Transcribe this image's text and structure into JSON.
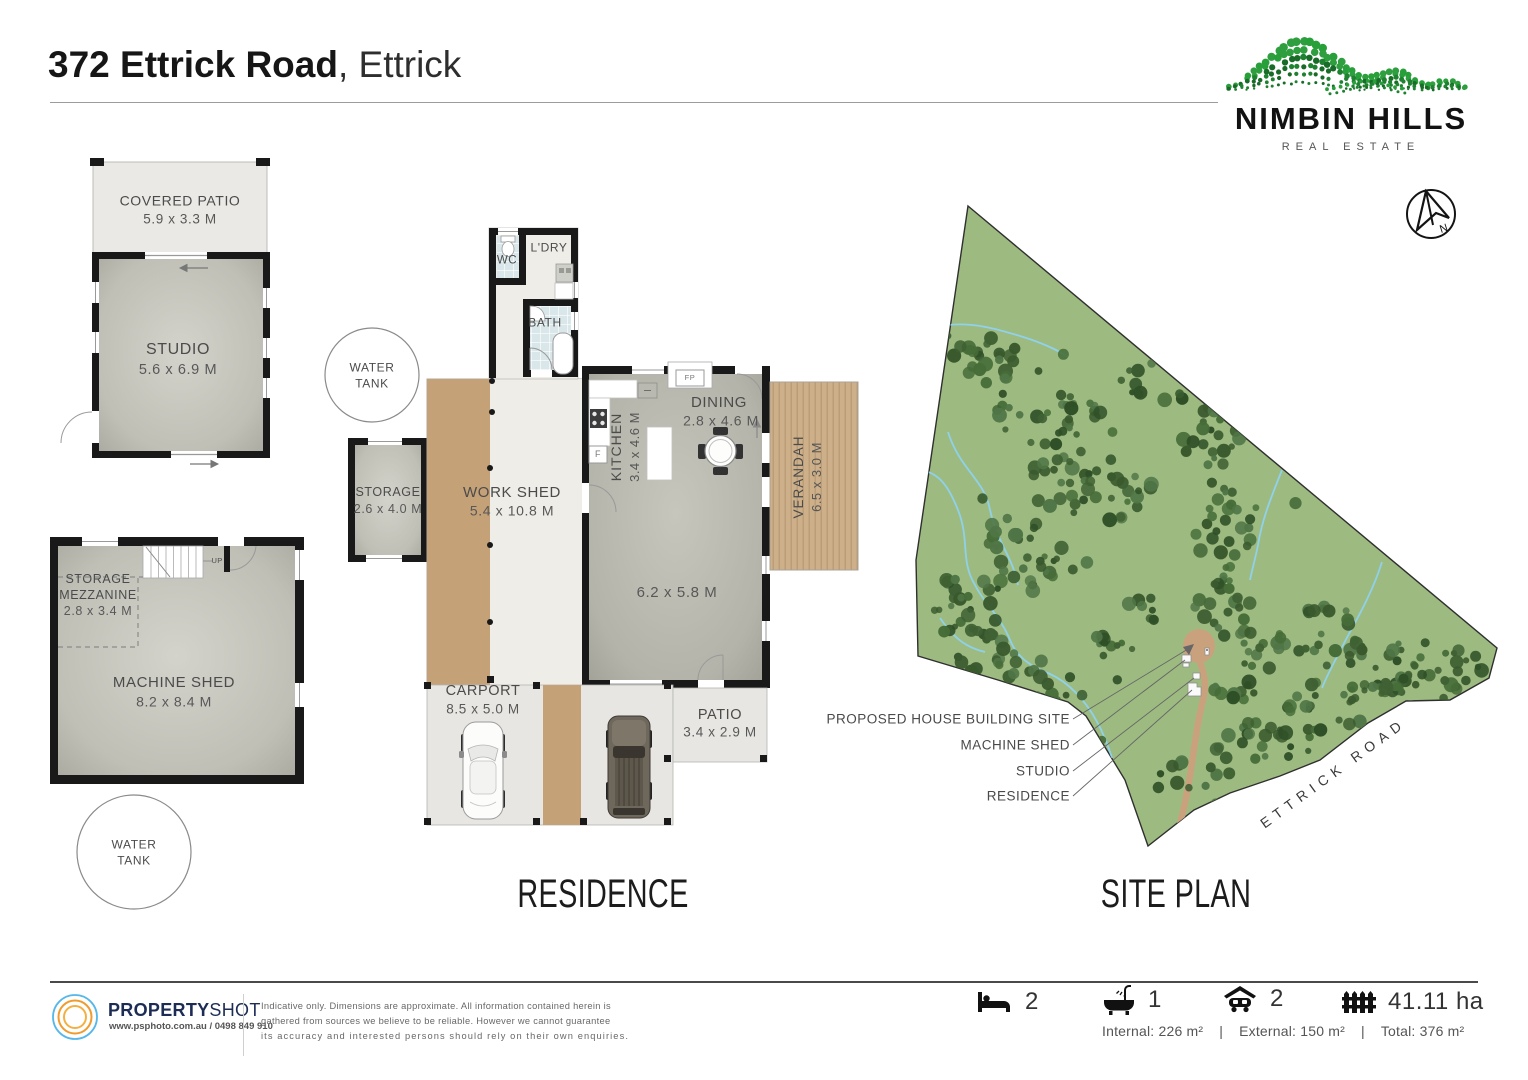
{
  "header": {
    "title_bold": "372 Ettrick Road",
    "title_light": ", Ettrick"
  },
  "brand": {
    "name": "NIMBIN HILLS",
    "tagline": "REAL ESTATE",
    "north": "N"
  },
  "floorplan": {
    "covered_patio": {
      "name": "COVERED PATIO",
      "dims": "5.9 x 3.3 M"
    },
    "studio": {
      "name": "STUDIO",
      "dims": "5.6 x 6.9 M"
    },
    "water_tank_upper": {
      "line1": "WATER",
      "line2": "TANK"
    },
    "water_tank_lower": {
      "line1": "WATER",
      "line2": "TANK"
    },
    "storage_mezzanine": {
      "line1": "STORAGE",
      "line2": "MEZZANINE",
      "dims": "2.8 x 3.4 M"
    },
    "machine_shed": {
      "name": "MACHINE SHED",
      "dims": "8.2 x 8.4 M"
    },
    "storage": {
      "name": "STORAGE",
      "dims": "2.6 x 4.0 M"
    },
    "work_shed": {
      "name": "WORK SHED",
      "dims": "5.4 x 10.8 M"
    },
    "wc": "WC",
    "ldry": "L'DRY",
    "bath": "BATH",
    "kitchen": {
      "name": "KITCHEN",
      "dims": "3.4 x 4.6 M"
    },
    "dining": {
      "name": "DINING",
      "dims": "2.8 x 4.6 M"
    },
    "verandah": {
      "name": "VERANDAH",
      "dims": "6.5 x 3.0 M"
    },
    "living_dims": "6.2 x 5.8 M",
    "carport": {
      "name": "CARPORT",
      "dims": "8.5 x 5.0 M"
    },
    "patio": {
      "name": "PATIO",
      "dims": "3.4 x 2.9 M"
    },
    "fireplace": "FP",
    "fridge": "F",
    "stairs_up": "UP",
    "headings": {
      "residence": "RESIDENCE",
      "siteplan": "SITE PLAN"
    }
  },
  "siteplan": {
    "labels": [
      "PROPOSED HOUSE BUILDING SITE",
      "MACHINE SHED",
      "STUDIO",
      "RESIDENCE"
    ],
    "road": "ETTRICK ROAD",
    "colors": {
      "grass": "#9dbb80",
      "tree": "#3a5a2e",
      "stream": "#8fd2f0",
      "driveway": "#c9a27d"
    }
  },
  "footer": {
    "logo": {
      "bold": "PROPERTY",
      "light": "SHOT",
      "contact": "www.psphoto.com.au / 0498 849 910"
    },
    "disclaimer": [
      "Indicative only.  Dimensions are approximate.  All information contained herein is",
      "gathered from sources we believe to be reliable.  However we cannot guarantee",
      "its accuracy and interested persons should rely on their own enquiries."
    ],
    "stats": {
      "beds": "2",
      "baths": "1",
      "cars": "2",
      "land": "41.11 ha"
    },
    "areas": {
      "internal": "Internal: 226 m²",
      "separator": "|",
      "external": "External: 150 m²",
      "total": "Total: 376 m²"
    }
  }
}
